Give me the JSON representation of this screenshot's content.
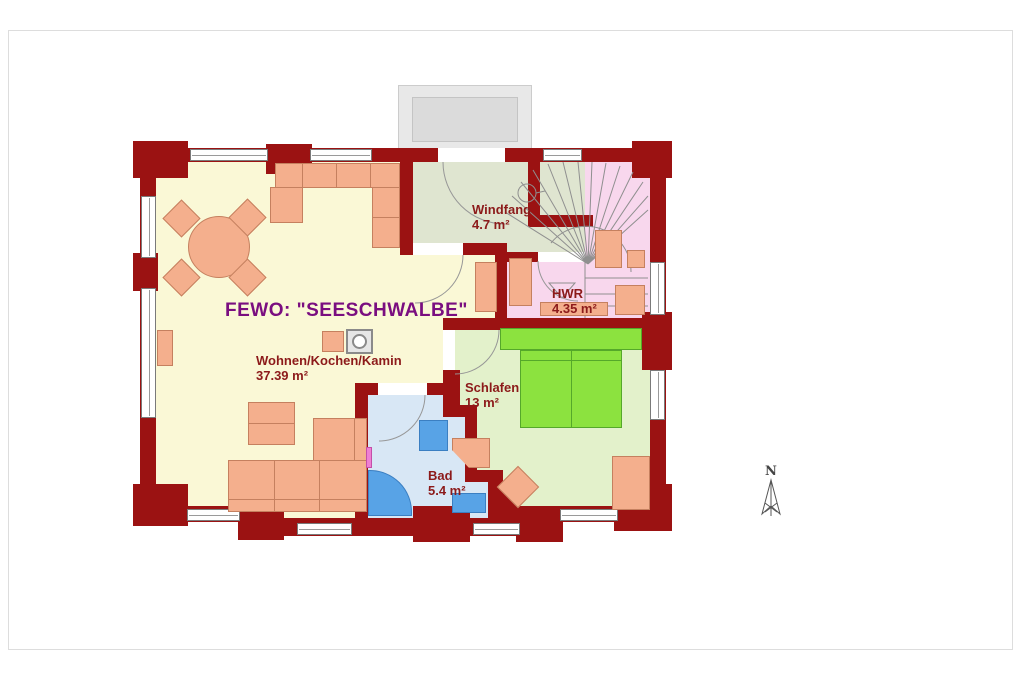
{
  "plan": {
    "title": "FEWO: \"SEESCHWALBE\"",
    "rooms": [
      {
        "id": "wohnen",
        "name": "Wohnen/Kochen/Kamin",
        "area": "37.39 m²"
      },
      {
        "id": "windfang",
        "name": "Windfang",
        "area": "4.7 m²"
      },
      {
        "id": "hwr",
        "name": "HWR",
        "area": "4.35 m²"
      },
      {
        "id": "schlafen",
        "name": "Schlafen",
        "area": "13 m²"
      },
      {
        "id": "bad",
        "name": "Bad",
        "area": "5.4 m²"
      }
    ],
    "compass_label": "N",
    "colors": {
      "wall": "#9B1212",
      "living_floor": "#FAF8D6",
      "windfang_floor": "#DFE5D0",
      "hwr_stairs_floor": "#F8D7ED",
      "schlafen_floor": "#E3F1CB",
      "bad_floor": "#D8E7F5",
      "bed": "#8CE23F",
      "bath_fixtures": "#58A3E6",
      "furniture": "#F4AF8D",
      "title_text": "#7A0E80",
      "room_label_text": "#8C1A1A"
    }
  }
}
